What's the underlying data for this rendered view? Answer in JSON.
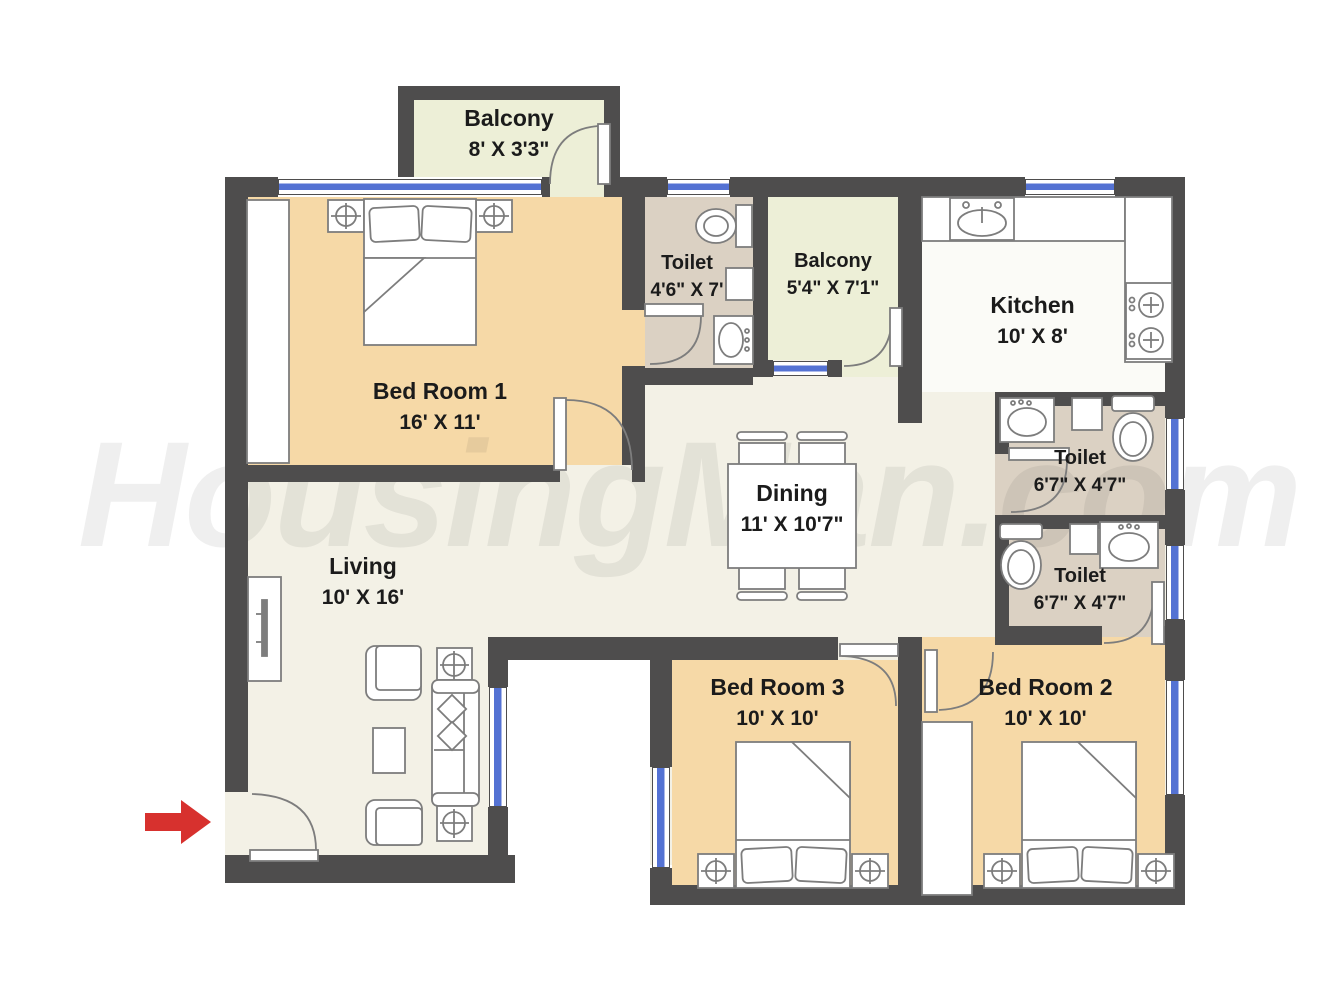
{
  "watermark": {
    "text": "HousingMan.com"
  },
  "rooms": {
    "balcony_top": {
      "name": "Balcony",
      "size": "8' X 3'3\""
    },
    "bedroom1": {
      "name": "Bed Room 1",
      "size": "16' X 11'"
    },
    "toilet_top": {
      "name": "Toilet",
      "size": "4'6\" X 7'"
    },
    "balcony_right": {
      "name": "Balcony",
      "size": "5'4\" X 7'1\""
    },
    "kitchen": {
      "name": "Kitchen",
      "size": "10' X 8'"
    },
    "toilet_upper": {
      "name": "Toilet",
      "size": "6'7\" X 4'7\""
    },
    "toilet_lower": {
      "name": "Toilet",
      "size": "6'7\" X 4'7\""
    },
    "dining": {
      "name": "Dining",
      "size": "11' X 10'7\""
    },
    "living": {
      "name": "Living",
      "size": "10' X 16'"
    },
    "bedroom3": {
      "name": "Bed Room 3",
      "size": "10' X 10'"
    },
    "bedroom2": {
      "name": "Bed Room 2",
      "size": "10' X 10'"
    }
  },
  "colors": {
    "wall": "#4e4d4d",
    "bedroom_floor": "#f6d9a7",
    "balcony_floor": "#edefd7",
    "toilet_floor": "#dbd1c3",
    "living_floor": "#f3f1e6",
    "kitchen_floor": "#fbfbf7",
    "window": "#5472d3",
    "entrance_arrow": "#d7312e"
  },
  "icons": {
    "entrance_arrow": "entrance-direction-arrow"
  }
}
